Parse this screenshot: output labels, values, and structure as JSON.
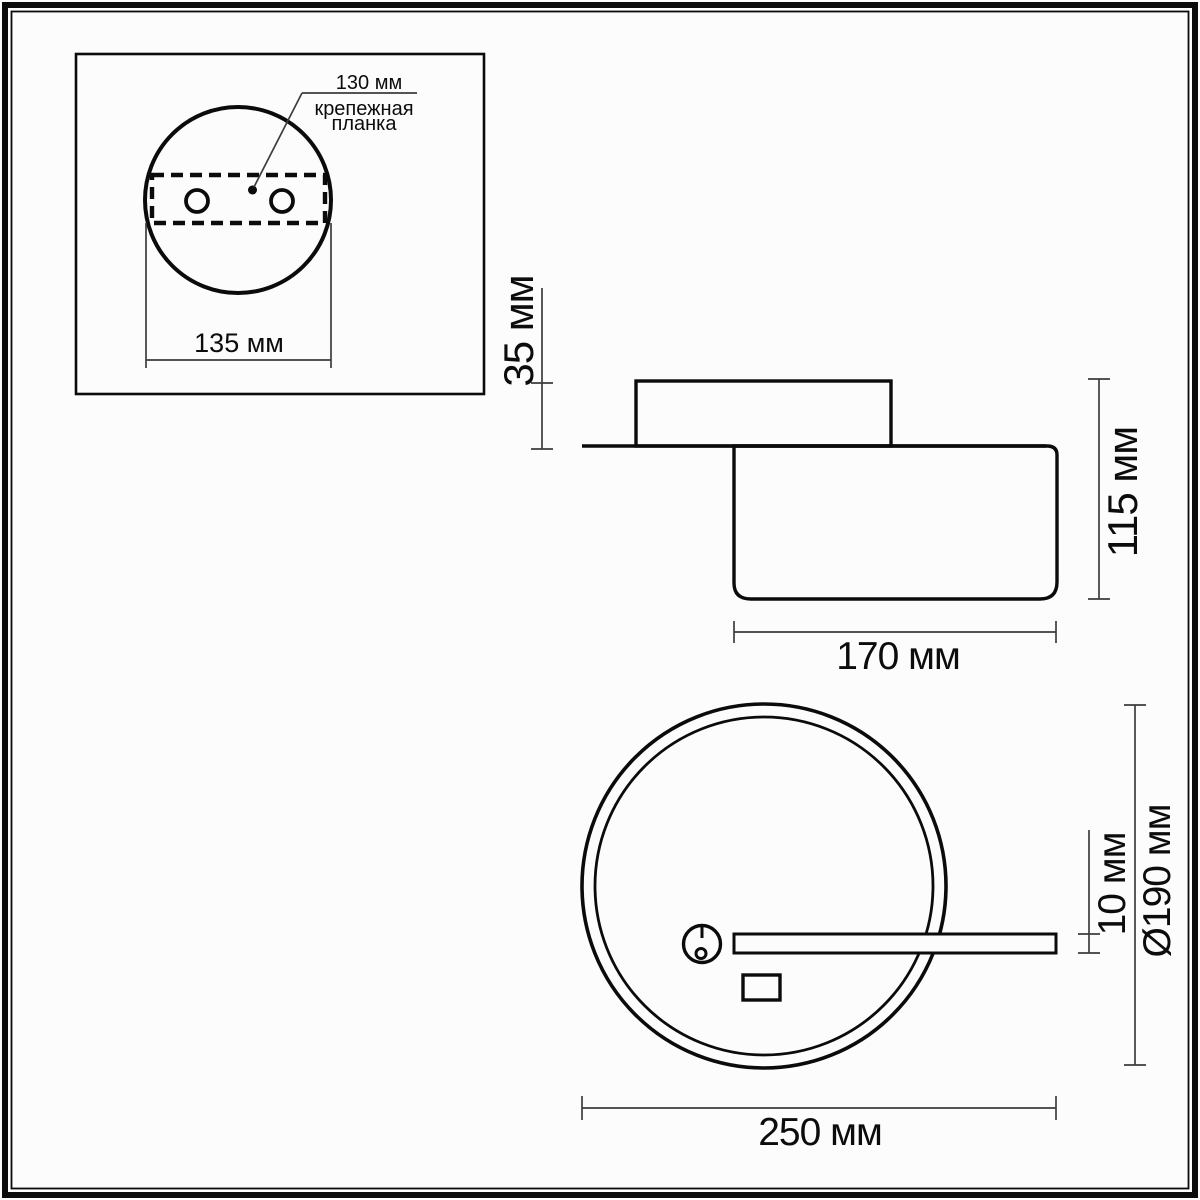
{
  "drawing": {
    "title": "Технический чертёж светильника (габаритные размеры)",
    "colors": {
      "background": "#fcfcfc",
      "object_line": "#0b0b0b",
      "dimension_line": "#3d3d3d",
      "text": "#0c0c0c"
    },
    "inset": {
      "callout_value": "130 мм",
      "callout_label_line1": "крепежная",
      "callout_label_line2": "планка",
      "plate_width_label": "135 мм"
    },
    "side_view": {
      "mount_height_label": "35 мм",
      "total_height_label": "115 мм",
      "body_width_label": "170 мм"
    },
    "front_view": {
      "arm_thickness_label": "10 мм",
      "ring_diameter_label": "Ø190 мм",
      "total_width_label": "250 мм"
    }
  }
}
